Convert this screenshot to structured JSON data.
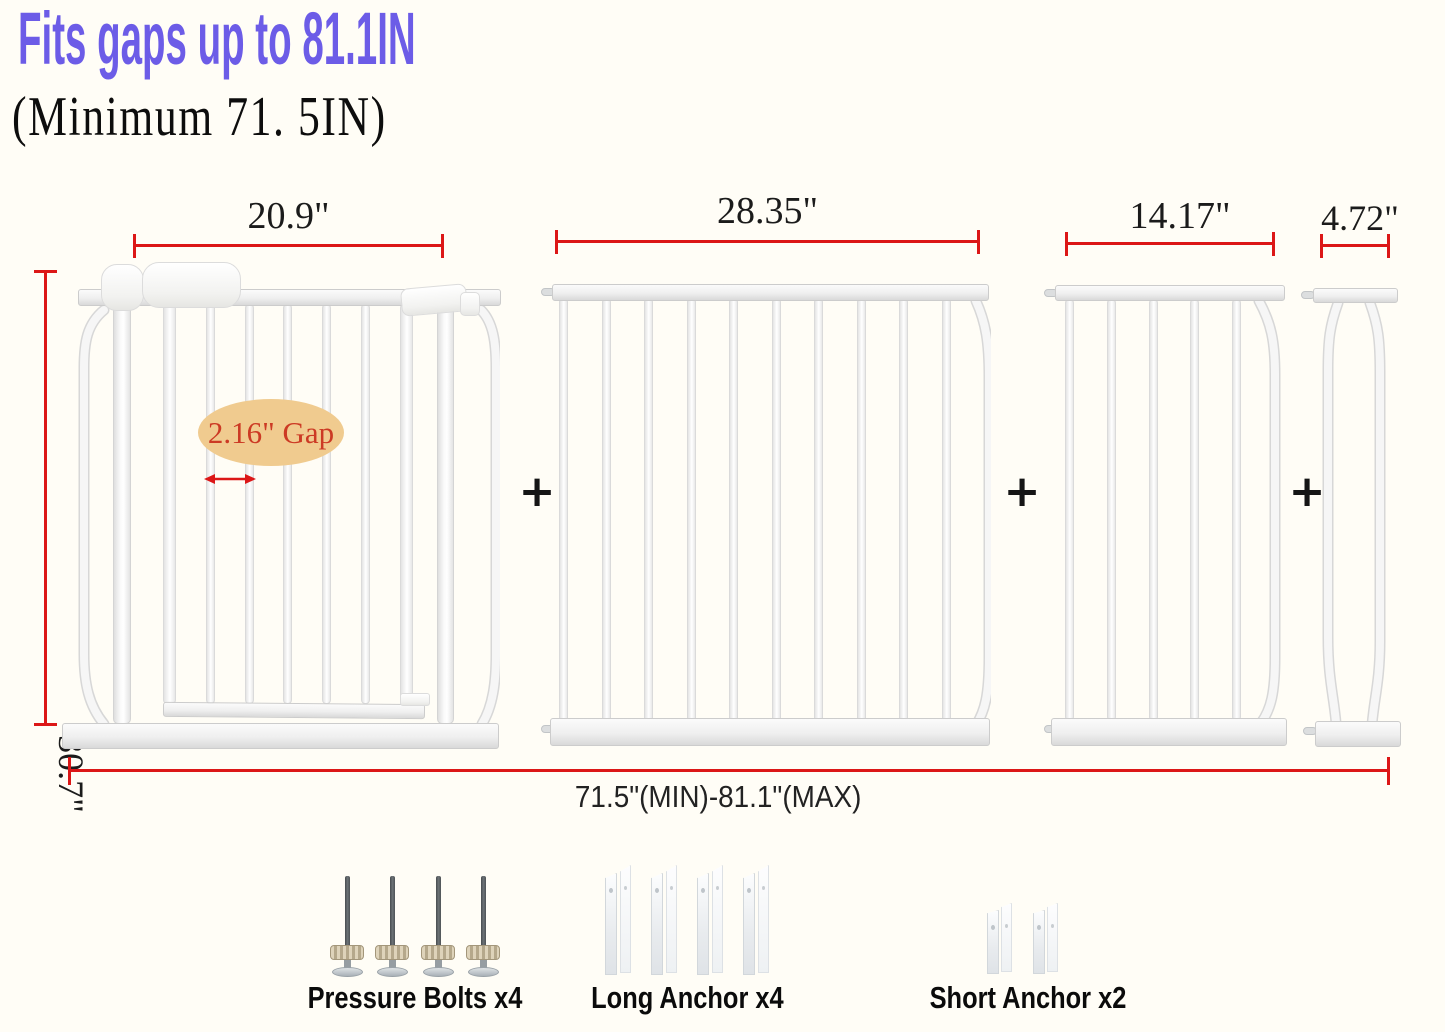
{
  "header": {
    "title": "Fits gaps up to 81.1IN",
    "subtitle": "(Minimum 71. 5IN)"
  },
  "panels": [
    {
      "width_label": "20.9\""
    },
    {
      "width_label": "28.35\""
    },
    {
      "width_label": "14.17\""
    },
    {
      "width_label": "4.72\""
    }
  ],
  "dimensions": {
    "height_label": "30.7\"",
    "total_label": "71.5\"(MIN)-81.1\"(MAX)",
    "gap_label": "2.16\" Gap"
  },
  "operators": {
    "plus": "+"
  },
  "hardware": [
    {
      "label": "Pressure Bolts x4"
    },
    {
      "label": "Long Anchor x4"
    },
    {
      "label": "Short Anchor x2"
    }
  ],
  "colors": {
    "title_purple": "#6c5ce7",
    "dimension_red": "#dc1717",
    "gap_badge_bg": "#f0cb8f",
    "gap_text": "#cc3a24"
  }
}
